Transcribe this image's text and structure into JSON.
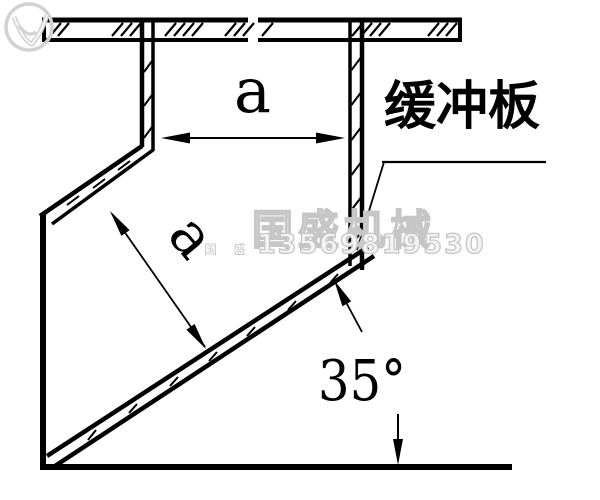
{
  "labels": {
    "width_dim": "a",
    "gap_dim": "a",
    "angle": "35°",
    "part": "缓冲板"
  },
  "watermark": {
    "brand": "国盛机械",
    "phone": "13569819530",
    "seal": "国 盛",
    "logo_icon": "leaf-checkmark-logo",
    "color": "#c9c9c9"
  },
  "colors": {
    "ink": "#000000",
    "paper": "#ffffff"
  }
}
